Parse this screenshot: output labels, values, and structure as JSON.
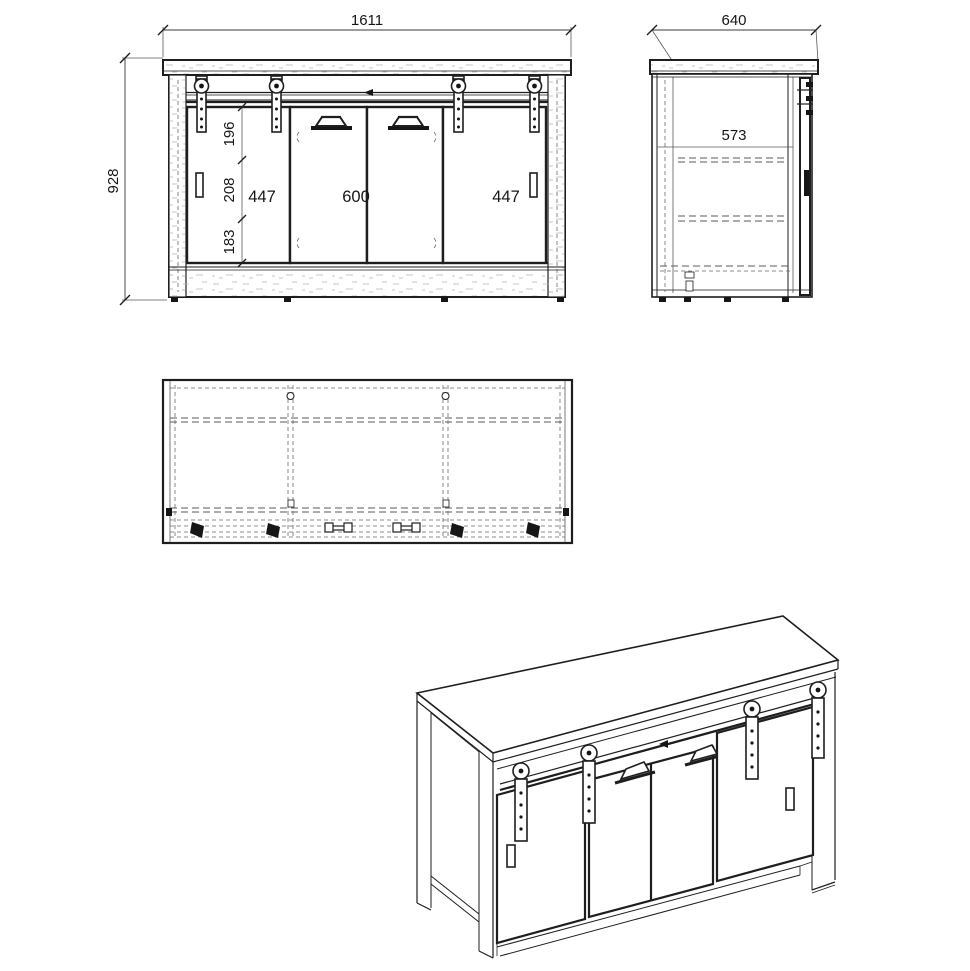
{
  "drawing": {
    "colors": {
      "background": "#ffffff",
      "line": "#1e1e1e",
      "dashed_line": "#5a5a5a"
    },
    "front_view": {
      "overall_width": "1611",
      "overall_height": "928",
      "compartment_left": "447",
      "compartment_center": "600",
      "compartment_right": "447",
      "section_top": "196",
      "section_middle": "208",
      "section_bottom": "183"
    },
    "side_view": {
      "overall_depth": "640",
      "inner_depth": "573"
    }
  }
}
